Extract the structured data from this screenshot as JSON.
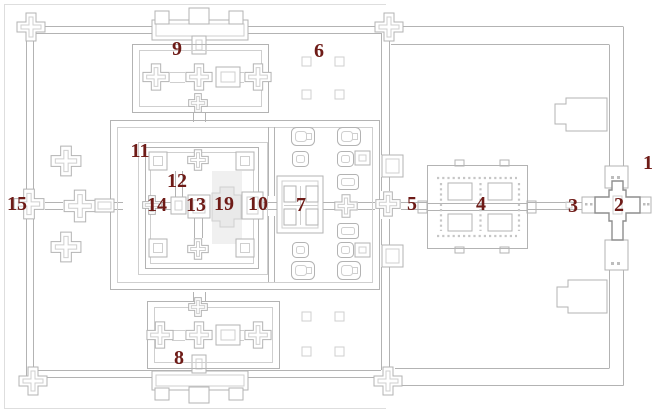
{
  "plan": {
    "background": "#ffffff",
    "colors": {
      "line": "#b3b3b3",
      "line_light": "#cfcfcf",
      "line_faint": "#dedede",
      "line_dark": "#8e8e8e",
      "label": "#6e1b17"
    },
    "labels": [
      {
        "text": "1",
        "x": 648,
        "y": 163
      },
      {
        "text": "2",
        "x": 619,
        "y": 205
      },
      {
        "text": "3",
        "x": 573,
        "y": 206
      },
      {
        "text": "4",
        "x": 481,
        "y": 204
      },
      {
        "text": "5",
        "x": 412,
        "y": 204
      },
      {
        "text": "6",
        "x": 319,
        "y": 51
      },
      {
        "text": "7",
        "x": 301,
        "y": 205
      },
      {
        "text": "8",
        "x": 179,
        "y": 358
      },
      {
        "text": "9",
        "x": 177,
        "y": 49
      },
      {
        "text": "10",
        "x": 258,
        "y": 204
      },
      {
        "text": "11",
        "x": 140,
        "y": 151
      },
      {
        "text": "12",
        "x": 177,
        "y": 181
      },
      {
        "text": "13",
        "x": 196,
        "y": 205
      },
      {
        "text": "14",
        "x": 157,
        "y": 205
      },
      {
        "text": "15",
        "x": 17,
        "y": 204
      },
      {
        "text": "19",
        "x": 224,
        "y": 204
      }
    ]
  }
}
